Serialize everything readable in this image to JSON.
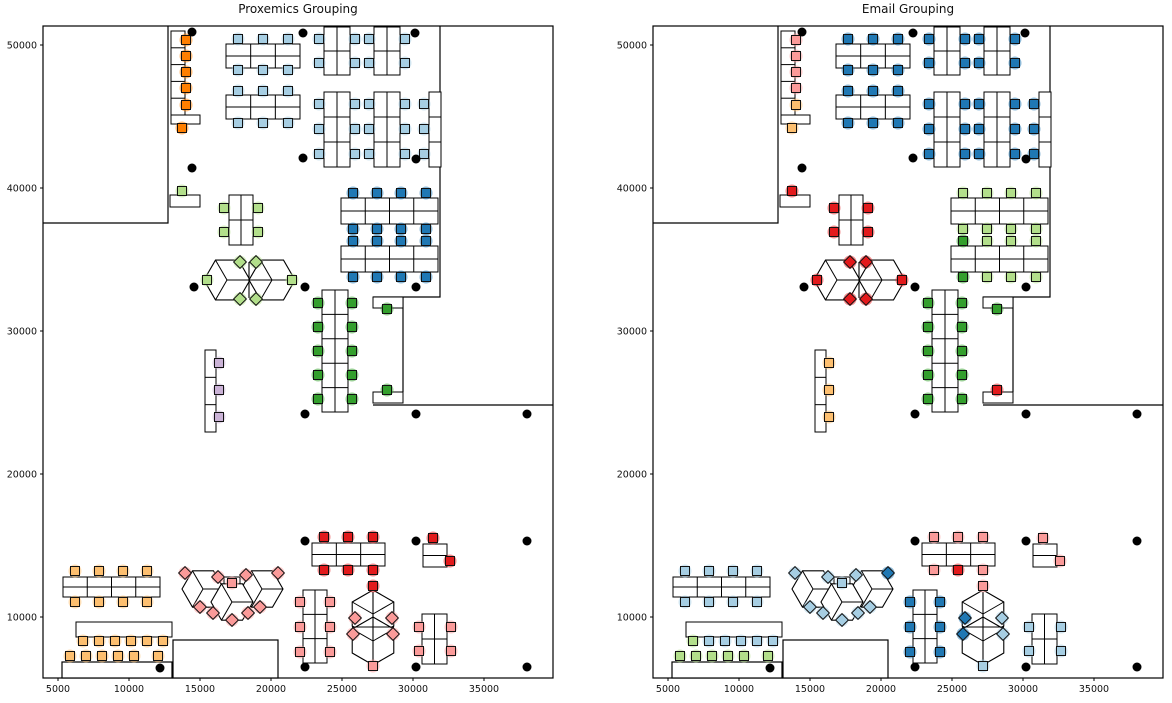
{
  "titles": {
    "left": "Proxemics Grouping",
    "right": "Email Grouping"
  },
  "figure": {
    "width": 1172,
    "height": 703,
    "background": "#ffffff",
    "panel_dx": 610
  },
  "palette": {
    "lb": "#A6CEE3",
    "db": "#1F78B4",
    "lg": "#B2DF8A",
    "g": "#33A02C",
    "pk": "#FB9A99",
    "r": "#E31A1C",
    "lo": "#FDBF6F",
    "o": "#FF7F00",
    "pu": "#CAB2D6",
    "dot": "#000000",
    "wall": "#000000",
    "desk_fill": "#ffffff"
  },
  "chart_data": {
    "type": "scatter",
    "subtype": "office-floorplan-seat-grouping",
    "panels": [
      {
        "id": "proxemics",
        "title": "Proxemics Grouping",
        "seat_color_key": "p"
      },
      {
        "id": "email",
        "title": "Email Grouping",
        "seat_color_key": "e"
      }
    ],
    "xlabel": "",
    "ylabel": "",
    "x_ticks": [
      5000,
      10000,
      15000,
      20000,
      25000,
      30000,
      35000
    ],
    "y_ticks": [
      10000,
      20000,
      30000,
      40000,
      50000
    ],
    "x_tick_px": [
      58,
      129,
      200,
      271,
      342,
      413,
      484
    ],
    "y_tick_px": [
      617,
      474,
      331,
      188,
      45
    ],
    "xlim": [
      3900,
      39900
    ],
    "ylim": [
      5700,
      51400
    ],
    "px_to_data": {
      "x": "data_x = 5000 + (px_x - 58) * 70.4",
      "y": "data_y = 10000 + (617 - px_y) * 69.9"
    },
    "layout": {
      "frame": [
        43,
        26,
        510,
        652
      ],
      "walls": [
        [
          [
            168,
            26
          ],
          [
            168,
            223
          ],
          [
            43,
            223
          ]
        ],
        [
          [
            440,
            26
          ],
          [
            440,
            297
          ],
          [
            373,
            297
          ]
        ],
        [
          [
            403,
            297
          ],
          [
            403,
            392
          ]
        ],
        [
          [
            373,
            405
          ],
          [
            553,
            405
          ]
        ]
      ],
      "wall_rooms": [
        [
          173,
          640,
          105,
          38
        ],
        [
          62,
          662,
          110,
          16
        ]
      ],
      "desks": [
        [
          171,
          31,
          14,
          84,
          1,
          5
        ],
        [
          171,
          115,
          29,
          9,
          1,
          1
        ],
        [
          226,
          44,
          74,
          24,
          3,
          2
        ],
        [
          226,
          95,
          74,
          24,
          3,
          2
        ],
        [
          324,
          27,
          26,
          48,
          2,
          2
        ],
        [
          374,
          27,
          26,
          48,
          2,
          2
        ],
        [
          324,
          92,
          26,
          75,
          2,
          3
        ],
        [
          374,
          92,
          26,
          75,
          2,
          3
        ],
        [
          429,
          92,
          12,
          75,
          1,
          3
        ],
        [
          170,
          195,
          30,
          12,
          1,
          1
        ],
        [
          229,
          195,
          24,
          50,
          2,
          2
        ],
        [
          341,
          198,
          97,
          26,
          4,
          2
        ],
        [
          341,
          246,
          97,
          26,
          4,
          2
        ],
        [
          322,
          290,
          26,
          122,
          2,
          5
        ],
        [
          373,
          297,
          30,
          11,
          1,
          1
        ],
        [
          373,
          392,
          30,
          11,
          1,
          1
        ],
        [
          205,
          350,
          11,
          82,
          1,
          3
        ],
        [
          63,
          577,
          97,
          20,
          4,
          2
        ],
        [
          76,
          622,
          96,
          15,
          1,
          1
        ],
        [
          312,
          543,
          73,
          23,
          3,
          2
        ],
        [
          423,
          544,
          24,
          23,
          1,
          2
        ],
        [
          303,
          590,
          24,
          73,
          2,
          3
        ],
        [
          422,
          614,
          25,
          50,
          2,
          2
        ],
        [
          224,
          577,
          16,
          11,
          1,
          1
        ]
      ],
      "pods": [
        [
          227,
          280,
          23,
          0
        ],
        [
          272,
          280,
          23,
          0
        ],
        [
          373,
          614,
          24,
          90
        ],
        [
          373,
          641,
          24,
          90
        ],
        [
          203,
          589,
          21,
          0
        ],
        [
          262,
          589,
          21,
          0
        ],
        [
          232,
          602,
          21,
          0
        ]
      ],
      "pod_lines": [
        [
          [
            249,
            262
          ],
          [
            249,
            298
          ]
        ],
        [
          [
            227,
            280
          ],
          [
            272,
            280
          ]
        ],
        [
          [
            373,
            592
          ],
          [
            373,
            663
          ]
        ],
        [
          [
            352,
            627
          ],
          [
            394,
            627
          ]
        ]
      ],
      "dots": [
        [
          192,
          32
        ],
        [
          303,
          33
        ],
        [
          415,
          33
        ],
        [
          192,
          168
        ],
        [
          303,
          158
        ],
        [
          416,
          159
        ],
        [
          194,
          287
        ],
        [
          305,
          287
        ],
        [
          416,
          287
        ],
        [
          305,
          414
        ],
        [
          416,
          414
        ],
        [
          527,
          414
        ],
        [
          305,
          541
        ],
        [
          416,
          541
        ],
        [
          527,
          541
        ],
        [
          160,
          668
        ],
        [
          305,
          667
        ],
        [
          416,
          667
        ],
        [
          527,
          667
        ]
      ],
      "seats": [
        [
          186,
          40,
          "o",
          "pk",
          0
        ],
        [
          186,
          56,
          "o",
          "pk",
          0
        ],
        [
          186,
          72,
          "o",
          "pk",
          0
        ],
        [
          186,
          88,
          "o",
          "pk",
          0
        ],
        [
          186,
          105,
          "o",
          "lo",
          0
        ],
        [
          182,
          128,
          "o",
          "lo",
          0
        ],
        [
          238,
          39,
          "lb",
          "db",
          0
        ],
        [
          263,
          39,
          "lb",
          "db",
          0
        ],
        [
          288,
          39,
          "lb",
          "db",
          0
        ],
        [
          238,
          70,
          "lb",
          "db",
          0
        ],
        [
          263,
          70,
          "lb",
          "db",
          0
        ],
        [
          288,
          70,
          "lb",
          "db",
          0
        ],
        [
          238,
          91,
          "lb",
          "db",
          0
        ],
        [
          263,
          91,
          "lb",
          "db",
          0
        ],
        [
          288,
          91,
          "lb",
          "db",
          0
        ],
        [
          238,
          123,
          "lb",
          "db",
          0
        ],
        [
          263,
          123,
          "lb",
          "db",
          0
        ],
        [
          288,
          123,
          "lb",
          "db",
          0
        ],
        [
          319,
          39,
          "lb",
          "db",
          0
        ],
        [
          355,
          39,
          "lb",
          "db",
          0
        ],
        [
          319,
          63,
          "lb",
          "db",
          0
        ],
        [
          355,
          63,
          "lb",
          "db",
          0
        ],
        [
          369,
          39,
          "lb",
          "db",
          0
        ],
        [
          405,
          39,
          "lb",
          "db",
          0
        ],
        [
          369,
          63,
          "lb",
          "db",
          0
        ],
        [
          405,
          63,
          "lb",
          "db",
          0
        ],
        [
          319,
          104,
          "lb",
          "db",
          0
        ],
        [
          355,
          104,
          "lb",
          "db",
          0
        ],
        [
          319,
          129,
          "lb",
          "db",
          0
        ],
        [
          355,
          129,
          "lb",
          "db",
          0
        ],
        [
          319,
          154,
          "lb",
          "db",
          0
        ],
        [
          355,
          154,
          "lb",
          "db",
          0
        ],
        [
          369,
          104,
          "lb",
          "db",
          0
        ],
        [
          405,
          104,
          "lb",
          "db",
          0
        ],
        [
          369,
          129,
          "lb",
          "db",
          0
        ],
        [
          405,
          129,
          "lb",
          "db",
          0
        ],
        [
          369,
          154,
          "lb",
          "db",
          0
        ],
        [
          405,
          154,
          "lb",
          "db",
          0
        ],
        [
          424,
          104,
          "lb",
          "db",
          0
        ],
        [
          424,
          129,
          "lb",
          "db",
          0
        ],
        [
          424,
          154,
          "lb",
          "db",
          0
        ],
        [
          182,
          191,
          "lg",
          "r",
          0
        ],
        [
          224,
          208,
          "lg",
          "r",
          0
        ],
        [
          258,
          208,
          "lg",
          "r",
          0
        ],
        [
          224,
          232,
          "lg",
          "r",
          0
        ],
        [
          258,
          232,
          "lg",
          "r",
          0
        ],
        [
          353,
          193,
          "db",
          "lg",
          0
        ],
        [
          377,
          193,
          "db",
          "lg",
          0
        ],
        [
          401,
          193,
          "db",
          "lg",
          0
        ],
        [
          426,
          193,
          "db",
          "lg",
          0
        ],
        [
          353,
          229,
          "db",
          "lg",
          0
        ],
        [
          377,
          229,
          "db",
          "lg",
          0
        ],
        [
          401,
          229,
          "db",
          "lg",
          0
        ],
        [
          426,
          229,
          "db",
          "lg",
          0
        ],
        [
          353,
          241,
          "db",
          "g",
          0
        ],
        [
          377,
          241,
          "db",
          "lg",
          0
        ],
        [
          401,
          241,
          "db",
          "lg",
          0
        ],
        [
          426,
          241,
          "db",
          "lg",
          0
        ],
        [
          353,
          277,
          "db",
          "g",
          0
        ],
        [
          377,
          277,
          "db",
          "lg",
          0
        ],
        [
          401,
          277,
          "db",
          "lg",
          0
        ],
        [
          426,
          277,
          "db",
          "lg",
          0
        ],
        [
          240,
          262,
          "lg",
          "r",
          45
        ],
        [
          256,
          262,
          "lg",
          "r",
          45
        ],
        [
          207,
          280,
          "lg",
          "r",
          0
        ],
        [
          292,
          280,
          "lg",
          "r",
          0
        ],
        [
          240,
          299,
          "lg",
          "r",
          45
        ],
        [
          256,
          299,
          "lg",
          "r",
          45
        ],
        [
          318,
          303,
          "g",
          "g",
          0
        ],
        [
          352,
          303,
          "g",
          "g",
          0
        ],
        [
          318,
          327,
          "g",
          "g",
          0
        ],
        [
          352,
          327,
          "g",
          "g",
          0
        ],
        [
          318,
          351,
          "g",
          "g",
          0
        ],
        [
          352,
          351,
          "g",
          "g",
          0
        ],
        [
          318,
          375,
          "g",
          "g",
          0
        ],
        [
          352,
          375,
          "g",
          "g",
          0
        ],
        [
          318,
          399,
          "g",
          "g",
          0
        ],
        [
          352,
          399,
          "g",
          "g",
          0
        ],
        [
          387,
          309,
          "g",
          "g",
          0
        ],
        [
          387,
          390,
          "g",
          "r",
          0
        ],
        [
          219,
          363,
          "pu",
          "lo",
          0
        ],
        [
          219,
          390,
          "pu",
          "lo",
          0
        ],
        [
          219,
          417,
          "pu",
          "lo",
          0
        ],
        [
          75,
          571,
          "lo",
          "lb",
          0
        ],
        [
          99,
          571,
          "lo",
          "lb",
          0
        ],
        [
          123,
          571,
          "lo",
          "lb",
          0
        ],
        [
          147,
          571,
          "lo",
          "lb",
          0
        ],
        [
          75,
          602,
          "lo",
          "lb",
          0
        ],
        [
          99,
          602,
          "lo",
          "lb",
          0
        ],
        [
          123,
          602,
          "lo",
          "lb",
          0
        ],
        [
          147,
          602,
          "lo",
          "lb",
          0
        ],
        [
          83,
          641,
          "lo",
          "lg",
          0
        ],
        [
          99,
          641,
          "lo",
          "lb",
          0
        ],
        [
          115,
          641,
          "lo",
          "lb",
          0
        ],
        [
          131,
          641,
          "lo",
          "lb",
          0
        ],
        [
          147,
          641,
          "lo",
          "lb",
          0
        ],
        [
          163,
          641,
          "lo",
          "lb",
          0
        ],
        [
          70,
          656,
          "lo",
          "lg",
          0
        ],
        [
          86,
          656,
          "lo",
          "lg",
          0
        ],
        [
          102,
          656,
          "lo",
          "lg",
          0
        ],
        [
          118,
          656,
          "lo",
          "lg",
          0
        ],
        [
          134,
          656,
          "lo",
          "lg",
          0
        ],
        [
          158,
          656,
          "lo",
          "lg",
          0
        ],
        [
          185,
          573,
          "pk",
          "lb",
          45
        ],
        [
          218,
          577,
          "pk",
          "lb",
          45
        ],
        [
          232,
          583,
          "pk",
          "lb",
          0
        ],
        [
          246,
          575,
          "pk",
          "lb",
          45
        ],
        [
          278,
          573,
          "pk",
          "db",
          45
        ],
        [
          200,
          607,
          "pk",
          "lb",
          45
        ],
        [
          213,
          613,
          "pk",
          "lb",
          45
        ],
        [
          232,
          620,
          "pk",
          "lb",
          45
        ],
        [
          248,
          613,
          "pk",
          "lb",
          45
        ],
        [
          260,
          607,
          "pk",
          "lb",
          45
        ],
        [
          324,
          537,
          "r",
          "pk",
          0
        ],
        [
          348,
          537,
          "r",
          "pk",
          0
        ],
        [
          373,
          537,
          "r",
          "pk",
          0
        ],
        [
          324,
          570,
          "r",
          "pk",
          0
        ],
        [
          348,
          570,
          "r",
          "r",
          0
        ],
        [
          373,
          570,
          "r",
          "pk",
          0
        ],
        [
          433,
          538,
          "r",
          "pk",
          0
        ],
        [
          450,
          561,
          "r",
          "pk",
          0
        ],
        [
          300,
          602,
          "pk",
          "db",
          0
        ],
        [
          330,
          602,
          "pk",
          "db",
          0
        ],
        [
          300,
          627,
          "pk",
          "db",
          0
        ],
        [
          330,
          627,
          "pk",
          "db",
          0
        ],
        [
          300,
          652,
          "pk",
          "db",
          0
        ],
        [
          330,
          652,
          "pk",
          "db",
          0
        ],
        [
          373,
          586,
          "r",
          "pk",
          0
        ],
        [
          355,
          618,
          "pk",
          "db",
          45
        ],
        [
          353,
          634,
          "pk",
          "db",
          45
        ],
        [
          392,
          618,
          "pk",
          "lb",
          45
        ],
        [
          393,
          634,
          "pk",
          "lb",
          45
        ],
        [
          373,
          666,
          "pk",
          "lb",
          0
        ],
        [
          419,
          627,
          "pk",
          "lb",
          0
        ],
        [
          451,
          627,
          "pk",
          "lb",
          0
        ],
        [
          419,
          651,
          "pk",
          "lb",
          0
        ],
        [
          451,
          651,
          "pk",
          "lb",
          0
        ]
      ]
    }
  }
}
